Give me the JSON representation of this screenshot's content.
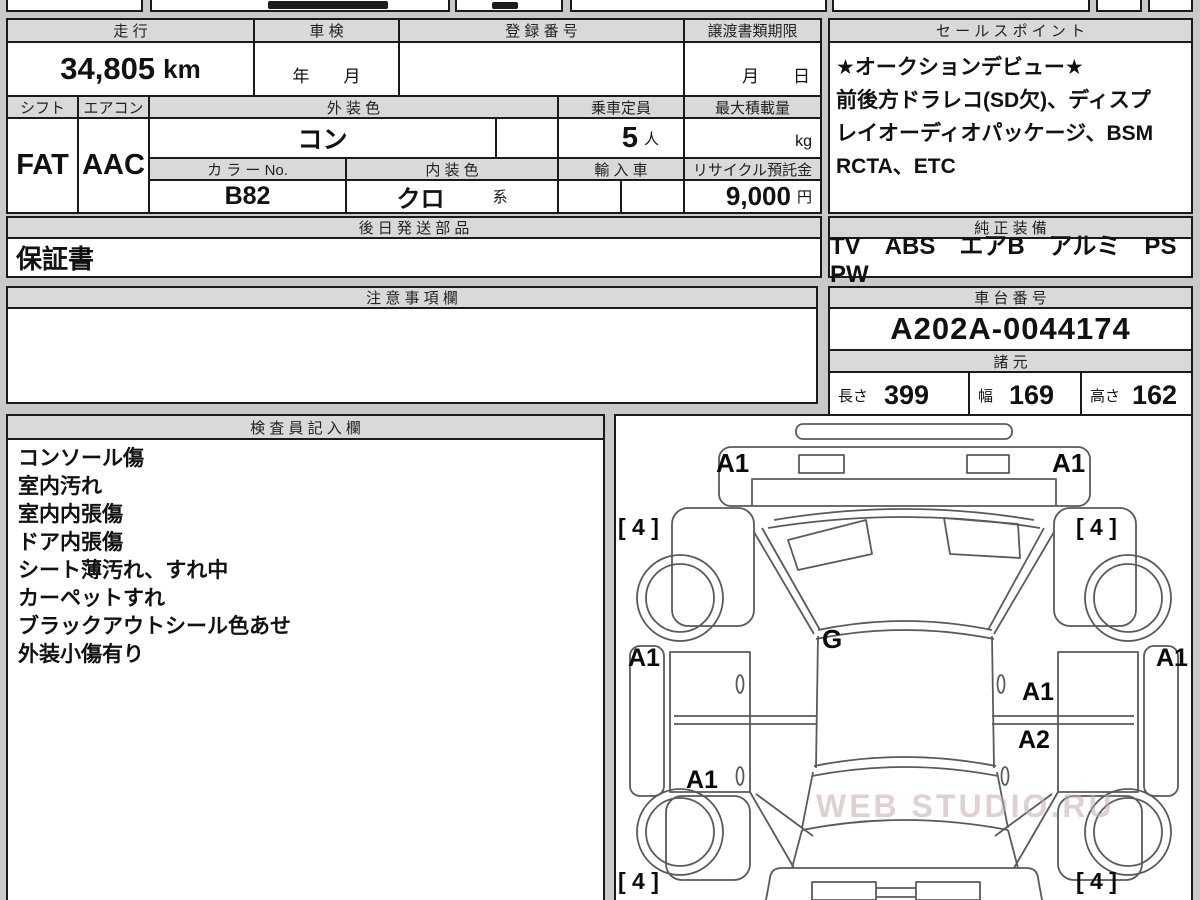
{
  "colors": {
    "page_bg": "#c9c9c9",
    "cell_bg": "#ffffff",
    "header_bg": "#d9d9d9",
    "border": "#1a1a1a",
    "diagram_line": "#5a5a5a"
  },
  "top": {
    "mileage_label": "走 行",
    "mileage_value": "34,805",
    "mileage_unit": "km",
    "shaken_label": "車 検",
    "shaken_value": "年　　月",
    "registration_label": "登 録 番 号",
    "registration_value": "",
    "transfer_label": "譲渡書類期限",
    "transfer_value": "月　　日",
    "shift_label": "シフト",
    "shift_value": "FAT",
    "aircon_label": "エアコン",
    "aircon_value": "AAC",
    "exterior_color_label": "外 装 色",
    "exterior_color_value": "コン",
    "capacity_label": "乗車定員",
    "capacity_value": "5",
    "capacity_unit": "人",
    "max_load_label": "最大積載量",
    "max_load_unit": "kg",
    "color_no_label": "カ ラ ー No.",
    "color_no_value": "B82",
    "interior_color_label": "内 装 色",
    "interior_color_value": "クロ",
    "interior_color_suffix": "系",
    "import_label": "輸 入 車",
    "recycle_label": "リサイクル預託金",
    "recycle_value": "9,000",
    "recycle_unit": "円"
  },
  "later_parts": {
    "header": "後 日 発 送 部 品",
    "content": "保証書"
  },
  "notes": {
    "header": "注 意 事 項 欄",
    "content": ""
  },
  "sales_point": {
    "header": "セ ー ル ス ポ イ ン ト",
    "lines": [
      "★オークションデビュー★",
      "前後方ドラレコ(SD欠)、ディスプ",
      "レイオーディオパッケージ、BSM",
      "RCTA、ETC"
    ]
  },
  "equipment": {
    "header": "純 正 装 備",
    "content": "TV　ABS　エアB　アルミ　PS　PW"
  },
  "chassis": {
    "header": "車 台 番 号",
    "number": "A202A-0044174"
  },
  "specs": {
    "header": "諸 元",
    "length_label": "長さ",
    "length_value": "399",
    "width_label": "幅",
    "width_value": "169",
    "height_label": "高さ",
    "height_value": "162"
  },
  "inspector": {
    "header": "検 査 員 記 入 欄",
    "lines": [
      "コンソール傷",
      "室内汚れ",
      "室内内張傷",
      "ドア内張傷",
      "シート薄汚れ、すれ中",
      "カーペットすれ",
      "ブラックアウトシール色あせ",
      "外装小傷有り"
    ]
  },
  "diagram": {
    "watermark": "WEB STUDIO.RU",
    "labels": {
      "front_left": "A1",
      "front_right": "A1",
      "front_wheel_left": "[ 4 ]",
      "front_wheel_right": "[ 4 ]",
      "rocker_left": "A1",
      "rocker_right": "A1",
      "roof": "G",
      "door_right_upper": "A1",
      "door_right_lower": "A2",
      "door_left_lower": "A1",
      "rear_wheel_left": "[ 4 ]",
      "rear_wheel_right": "[ 4 ]"
    }
  }
}
